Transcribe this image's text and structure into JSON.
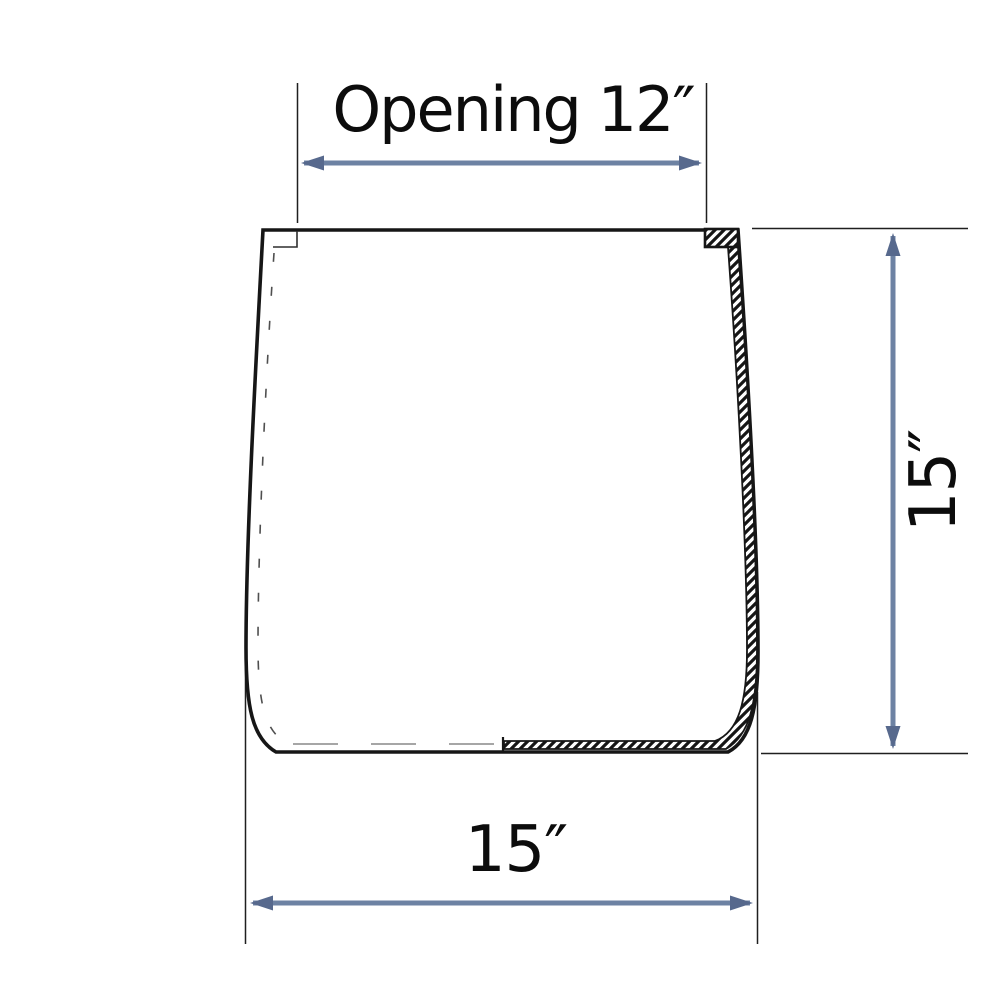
{
  "page": {
    "background_color": "#ffffff"
  },
  "drawing": {
    "subject": "planter-pot-cross-section",
    "outline_color": "#161616",
    "hidden_line_color": "#4f4f4f",
    "inner_bottom_dash_color": "#9a9a9a",
    "arrow_color": "#6d82a3",
    "arrowhead_color": "#57698d",
    "text_color": "#0c0c0c"
  },
  "dimensions": {
    "top": {
      "label": "Opening 12″",
      "orientation": "horizontal",
      "position": "top"
    },
    "right": {
      "label": "15″",
      "orientation": "vertical",
      "position": "right"
    },
    "bottom": {
      "label": "15″",
      "orientation": "horizontal",
      "position": "bottom"
    }
  }
}
